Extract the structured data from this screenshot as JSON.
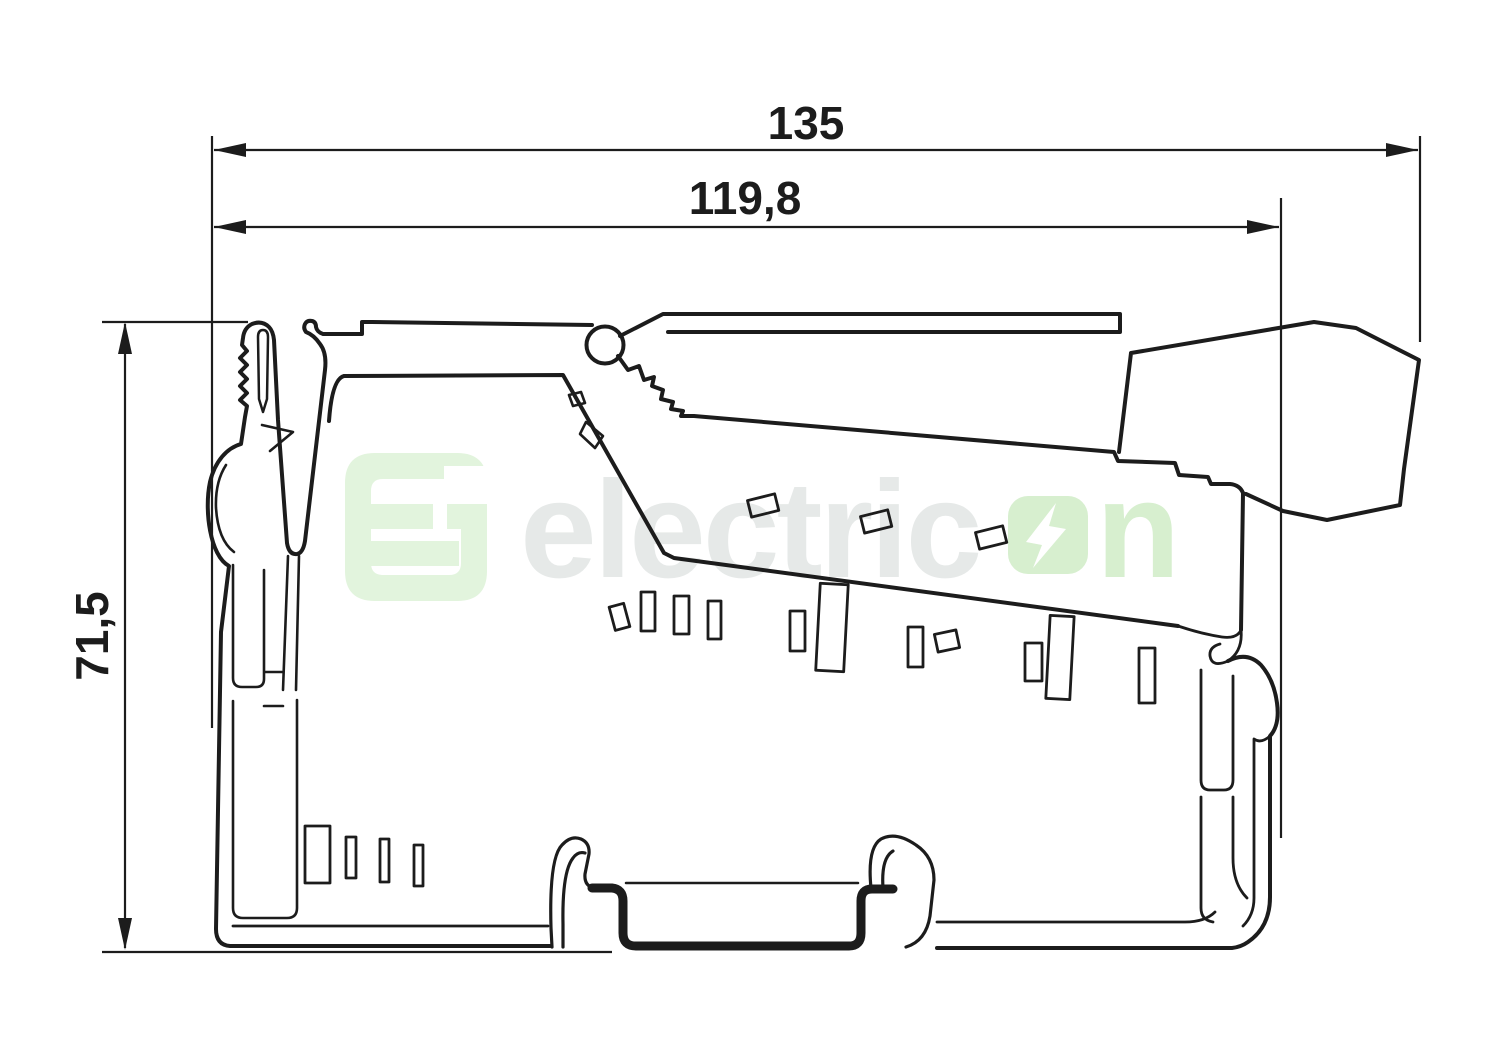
{
  "drawing": {
    "type": "technical-dimension-drawing",
    "subject": "DIN-rail I/O terminal module side profile",
    "dimensions": {
      "overall_width": "135",
      "upper_width": "119,8",
      "height": "71,5"
    }
  },
  "watermark": {
    "brand": "electricon",
    "text_grey": "electric",
    "text_green": "n",
    "o_icon": "lightning-bolt-in-rounded-square"
  },
  "colors": {
    "line": "#1c1c1c",
    "watermark_grey": "#e6e9e8",
    "watermark_green": "#d7efcf",
    "logo_green": "#e2f4dd",
    "bolt": "#ffffff",
    "background": "#ffffff"
  }
}
